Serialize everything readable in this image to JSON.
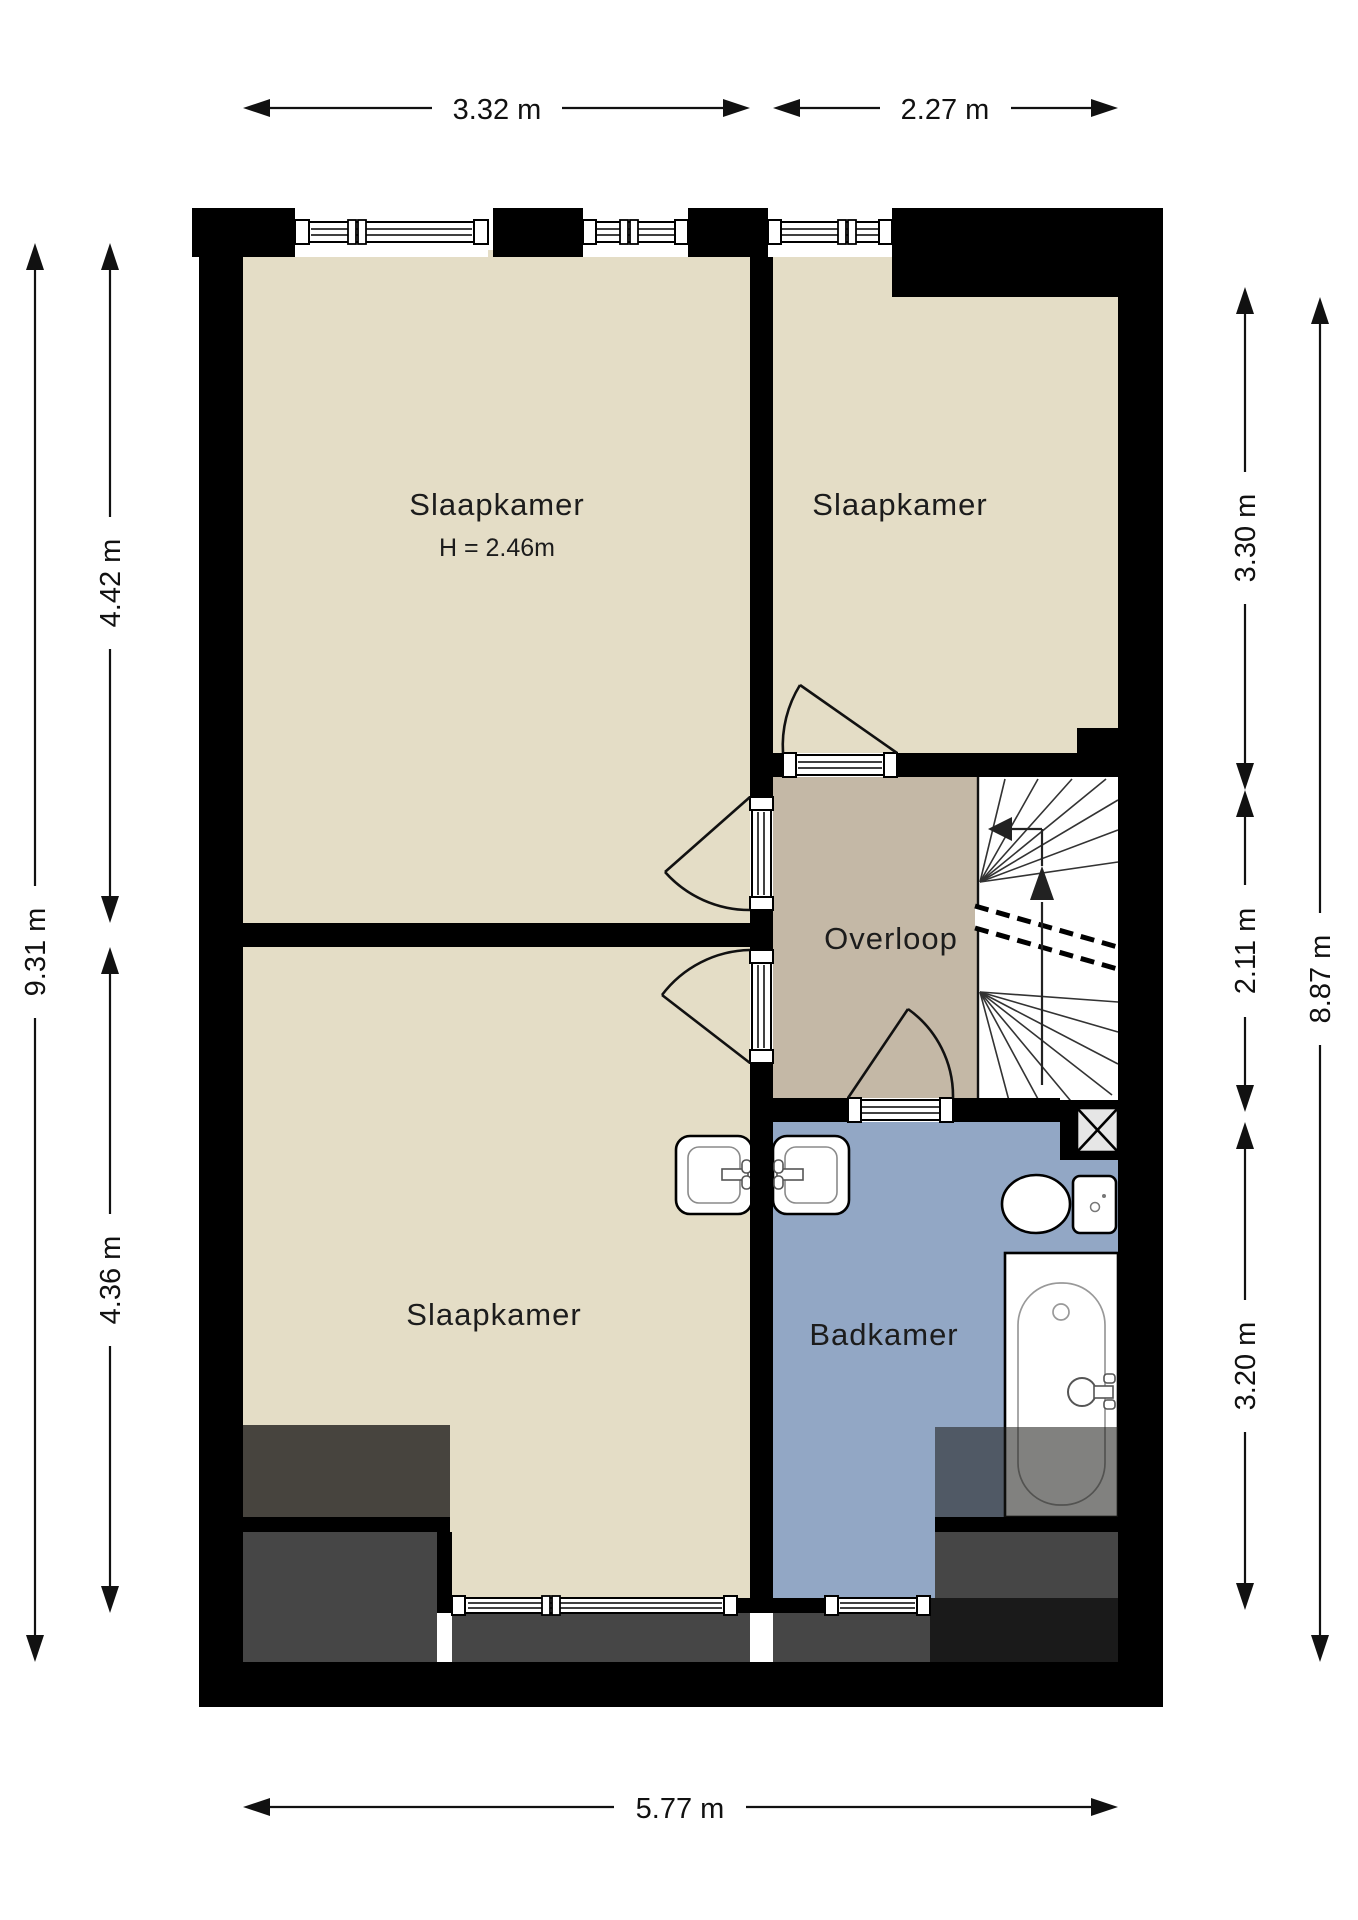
{
  "plan": {
    "rooms": {
      "bedroom_top_left": {
        "label": "Slaapkamer",
        "height_note": "H = 2.46m"
      },
      "bedroom_top_right": {
        "label": "Slaapkamer"
      },
      "bedroom_bottom_left": {
        "label": "Slaapkamer"
      },
      "landing": {
        "label": "Overloop"
      },
      "bathroom": {
        "label": "Badkamer"
      }
    },
    "dimensions": {
      "top_left_width": "3.32 m",
      "top_right_width": "2.27 m",
      "bottom_width": "5.77 m",
      "left_total_height": "9.31 m",
      "left_upper_height": "4.42 m",
      "left_lower_height": "4.36 m",
      "right_total_height": "8.87 m",
      "right_upper_height": "3.30 m",
      "right_middle_height": "2.11 m",
      "right_lower_height": "3.20 m"
    },
    "colors": {
      "floor": "#e4ddc6",
      "landing_floor": "#c4b8a6",
      "bathroom_floor": "#92a7c5",
      "wall": "#000000",
      "overlay_dark": "#47443e",
      "overlay_gray": "#464646"
    }
  }
}
